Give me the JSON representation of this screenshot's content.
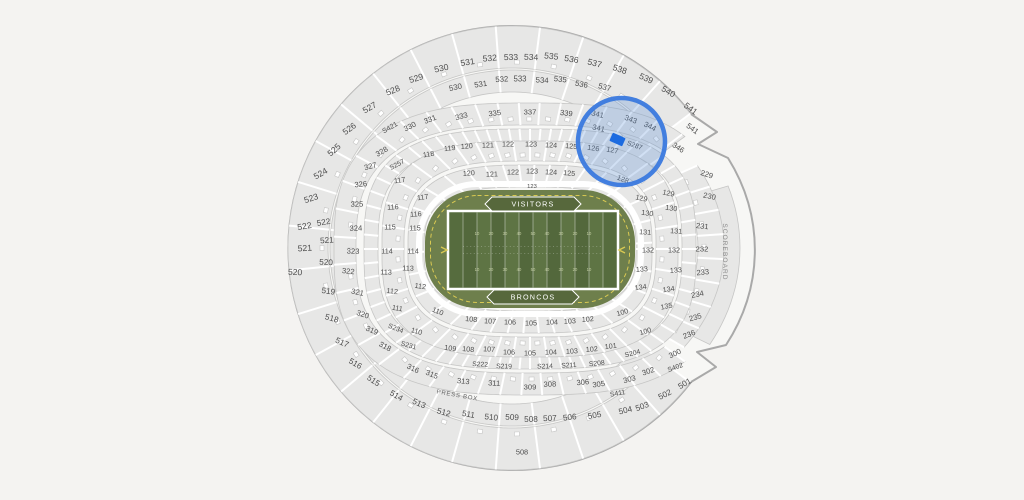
{
  "map": {
    "press_box_label": "PRESS BOX",
    "scoreboard_label": "SCOREBOARD",
    "bottom_gate_label": "508",
    "field": {
      "visitor_endzone_label": "VISITORS",
      "home_endzone_label": "BRONCOS",
      "yard_numbers": [
        "10",
        "20",
        "30",
        "40",
        "50",
        "40",
        "30",
        "20",
        "10"
      ]
    },
    "selection": {
      "highlighted_sections": [
        "341",
        "343",
        "344",
        "S287",
        "126",
        "127",
        "128"
      ],
      "highlight_stroke": "#3a79de",
      "highlight_fill": "#5b8fd6",
      "marker_color": "#1c6be0"
    },
    "colors": {
      "background": "#f4f3f1",
      "bowl_base": "#f7f7f5",
      "section_fill": "#e7e7e6",
      "section_stroke": "#c6c6c5",
      "outline": "#a9a9a9",
      "label": "#4e4e4e",
      "apron_green": "#6e7f4c",
      "stripe_dark": "#53683c",
      "stripe_light": "#5e7444",
      "endzone_green": "#566c3e",
      "banner_green": "#57683c",
      "accent_yellow": "#d9c952",
      "yard_number": "#c6d0a4",
      "scoreboard_fill": "#e9e9e8",
      "scoreboard_text": "#8a8a8a"
    },
    "label_format": [
      "text",
      "x",
      "y",
      "rotate",
      "font_size"
    ],
    "section_labels": [
      [
        "530",
        442,
        68,
        -13,
        8.6
      ],
      [
        "531",
        468,
        62,
        -9,
        8.6
      ],
      [
        "532",
        490,
        58,
        -5,
        8.6
      ],
      [
        "533",
        511,
        57,
        -1,
        8.6
      ],
      [
        "534",
        531,
        57,
        2,
        8.6
      ],
      [
        "535",
        551,
        56,
        6,
        8.6
      ],
      [
        "536",
        571,
        59,
        10,
        8.6
      ],
      [
        "537",
        594,
        63,
        14,
        8.6
      ],
      [
        "538",
        619,
        69,
        18,
        8.6
      ],
      [
        "539",
        645,
        78,
        24,
        8.6
      ],
      [
        "540",
        667,
        91,
        30,
        8.6
      ],
      [
        "541",
        689,
        108,
        36,
        8.6
      ],
      [
        "529",
        417,
        78,
        -17,
        8.6
      ],
      [
        "528",
        394,
        90,
        -23,
        8.6
      ],
      [
        "527",
        371,
        107,
        -30,
        8.6
      ],
      [
        "526",
        351,
        128,
        -36,
        8.6
      ],
      [
        "525",
        336,
        149,
        -42,
        8.6
      ],
      [
        "524",
        322,
        173,
        -30,
        8.6
      ],
      [
        "523",
        312,
        198,
        -18,
        8.6
      ],
      [
        "522",
        305,
        226,
        -10,
        8.6
      ],
      [
        "521",
        305,
        248,
        -4,
        8.6
      ],
      [
        "520",
        295,
        272,
        2,
        8.6
      ],
      [
        "522",
        324,
        222,
        -10,
        8.2
      ],
      [
        "521",
        327,
        240,
        -4,
        8.2
      ],
      [
        "520",
        326,
        262,
        2,
        8.2
      ],
      [
        "519",
        328,
        291,
        8,
        8.2
      ],
      [
        "518",
        331,
        318,
        16,
        8.2
      ],
      [
        "517",
        341,
        342,
        24,
        8.2
      ],
      [
        "516",
        354,
        363,
        30,
        8.2
      ],
      [
        "515",
        372,
        380,
        34,
        8.2
      ],
      [
        "514",
        395,
        395,
        30,
        8.2
      ],
      [
        "513",
        418,
        403,
        24,
        8.2
      ],
      [
        "512",
        443,
        412,
        16,
        8.2
      ],
      [
        "511",
        468,
        414,
        10,
        8.2
      ],
      [
        "510",
        491,
        417,
        6,
        8.2
      ],
      [
        "509",
        512,
        417,
        2,
        8.2
      ],
      [
        "508",
        531,
        419,
        0,
        8.2
      ],
      [
        "507",
        550,
        418,
        -2,
        8.2
      ],
      [
        "506",
        570,
        417,
        -6,
        8.2
      ],
      [
        "505",
        595,
        415,
        -10,
        8.2
      ],
      [
        "504",
        626,
        410,
        -14,
        8.2
      ],
      [
        "503",
        643,
        406,
        -20,
        8.2
      ],
      [
        "502",
        666,
        394,
        -26,
        8.2
      ],
      [
        "501",
        686,
        383,
        -31,
        8.2
      ],
      [
        "508",
        522,
        452,
        0,
        7.4
      ],
      [
        "530",
        456,
        87,
        -12,
        7.8
      ],
      [
        "531",
        481,
        84,
        -8,
        7.8
      ],
      [
        "532",
        502,
        79,
        -4,
        7.8
      ],
      [
        "533",
        520,
        79,
        0,
        7.8
      ],
      [
        "534",
        542,
        80,
        3,
        7.8
      ],
      [
        "535",
        560,
        79,
        7,
        7.8
      ],
      [
        "536",
        581,
        84,
        11,
        7.8
      ],
      [
        "537",
        604,
        87,
        15,
        7.8
      ],
      [
        "541",
        691,
        128,
        36,
        7.8
      ],
      [
        "331",
        431,
        119,
        -22,
        7.6
      ],
      [
        "330",
        411,
        126,
        -27,
        7.6
      ],
      [
        "S421",
        391,
        127,
        -30,
        7.0
      ],
      [
        "328",
        383,
        151,
        -30,
        7.6
      ],
      [
        "327",
        371,
        166,
        -14,
        7.6
      ],
      [
        "326",
        361,
        184,
        -6,
        7.6
      ],
      [
        "325",
        357,
        204,
        -1,
        7.6
      ],
      [
        "324",
        356,
        228,
        -2,
        7.6
      ],
      [
        "323",
        353,
        251,
        2,
        7.6
      ],
      [
        "322",
        348,
        271,
        6,
        7.6
      ],
      [
        "321",
        357,
        292,
        12,
        7.6
      ],
      [
        "320",
        362,
        314,
        18,
        7.6
      ],
      [
        "319",
        371,
        330,
        24,
        7.6
      ],
      [
        "318",
        384,
        346,
        28,
        7.6
      ],
      [
        "316",
        412,
        368,
        26,
        7.6
      ],
      [
        "315",
        431,
        374,
        22,
        7.6
      ],
      [
        "313",
        463,
        381,
        6,
        7.6
      ],
      [
        "311",
        494,
        383,
        3,
        7.6
      ],
      [
        "309",
        530,
        387,
        0,
        7.6
      ],
      [
        "308",
        550,
        384,
        -2,
        7.6
      ],
      [
        "306",
        583,
        382,
        -5,
        7.6
      ],
      [
        "305",
        599,
        384,
        -8,
        7.6
      ],
      [
        "303",
        630,
        379,
        -14,
        7.6
      ],
      [
        "302",
        649,
        371,
        -18,
        7.6
      ],
      [
        "300",
        676,
        353,
        -26,
        7.6
      ],
      [
        "333",
        462,
        116,
        -14,
        7.6
      ],
      [
        "335",
        495,
        113,
        -7,
        7.6
      ],
      [
        "337",
        530,
        112,
        0,
        7.6
      ],
      [
        "339",
        566,
        113,
        7,
        7.6
      ],
      [
        "341",
        597,
        114,
        13,
        7.6
      ],
      [
        "341",
        598,
        128,
        13,
        7.6
      ],
      [
        "343",
        630,
        119,
        20,
        7.6
      ],
      [
        "344",
        649,
        126,
        26,
        7.6
      ],
      [
        "346",
        677,
        147,
        33,
        7.6
      ],
      [
        "S257",
        398,
        164,
        -28,
        6.8
      ],
      [
        "S287",
        634,
        145,
        20,
        6.8
      ],
      [
        "S234",
        395,
        328,
        22,
        6.8
      ],
      [
        "S231",
        408,
        345,
        16,
        6.8
      ],
      [
        "S222",
        480,
        364,
        3,
        6.8
      ],
      [
        "S219",
        504,
        366,
        1,
        6.8
      ],
      [
        "S214",
        545,
        366,
        -1,
        6.8
      ],
      [
        "S211",
        569,
        365,
        -3,
        6.8
      ],
      [
        "S208",
        597,
        363,
        -6,
        6.8
      ],
      [
        "S204",
        633,
        353,
        -14,
        6.8
      ],
      [
        "S402",
        676,
        367,
        -20,
        6.8
      ],
      [
        "S411",
        618,
        393,
        -10,
        6.8
      ],
      [
        "118",
        429,
        154,
        -10,
        7.2
      ],
      [
        "119",
        450,
        148,
        -7,
        7.2
      ],
      [
        "120",
        467,
        146,
        -5,
        7.2
      ],
      [
        "121",
        488,
        145,
        -2,
        7.2
      ],
      [
        "122",
        508,
        144,
        0,
        7.2
      ],
      [
        "123",
        531,
        144,
        1,
        7.2
      ],
      [
        "124",
        551,
        145,
        3,
        7.2
      ],
      [
        "125",
        571,
        146,
        5,
        7.2
      ],
      [
        "126",
        593,
        148,
        8,
        7.2
      ],
      [
        "127",
        612,
        150,
        10,
        7.2
      ],
      [
        "128",
        622,
        179,
        22,
        7.2
      ],
      [
        "129",
        668,
        193,
        12,
        7.2
      ],
      [
        "130",
        671,
        208,
        8,
        7.2
      ],
      [
        "131",
        676,
        231,
        4,
        7.2
      ],
      [
        "132",
        674,
        250,
        0,
        7.2
      ],
      [
        "133",
        676,
        270,
        -4,
        7.2
      ],
      [
        "134",
        669,
        289,
        -8,
        7.2
      ],
      [
        "135",
        667,
        306,
        -12,
        7.2
      ],
      [
        "100",
        646,
        331,
        -16,
        7.2
      ],
      [
        "101",
        611,
        346,
        -7,
        7.2
      ],
      [
        "102",
        592,
        349,
        -5,
        7.2
      ],
      [
        "103",
        572,
        351,
        -3,
        7.2
      ],
      [
        "104",
        551,
        352,
        -1,
        7.2
      ],
      [
        "105",
        530,
        353,
        0,
        7.2
      ],
      [
        "106",
        509,
        352,
        1,
        7.2
      ],
      [
        "107",
        489,
        349,
        3,
        7.2
      ],
      [
        "108",
        468,
        349,
        5,
        7.2
      ],
      [
        "109",
        450,
        348,
        8,
        7.2
      ],
      [
        "110",
        416,
        331,
        16,
        7.2
      ],
      [
        "111",
        397,
        308,
        10,
        7.2
      ],
      [
        "112",
        392,
        291,
        6,
        7.2
      ],
      [
        "113",
        386,
        272,
        2,
        7.2
      ],
      [
        "114",
        387,
        251,
        0,
        7.2
      ],
      [
        "115",
        390,
        227,
        0,
        7.2
      ],
      [
        "116",
        393,
        207,
        -4,
        7.2
      ],
      [
        "117",
        400,
        180,
        -8,
        7.2
      ],
      [
        "120",
        469,
        173,
        -4,
        7.2
      ],
      [
        "121",
        492,
        174,
        -2,
        7.2
      ],
      [
        "122",
        513,
        172,
        0,
        7.2
      ],
      [
        "123",
        532,
        171,
        1,
        7.2
      ],
      [
        "124",
        551,
        172,
        3,
        7.2
      ],
      [
        "125",
        569,
        173,
        5,
        7.2
      ],
      [
        "123",
        532,
        186,
        0,
        5.8
      ],
      [
        "129",
        641,
        198,
        12,
        7.2
      ],
      [
        "130",
        647,
        213,
        8,
        7.2
      ],
      [
        "131",
        645,
        232,
        4,
        7.2
      ],
      [
        "132",
        648,
        250,
        0,
        7.2
      ],
      [
        "133",
        642,
        269,
        -4,
        7.2
      ],
      [
        "134",
        641,
        287,
        -8,
        7.2
      ],
      [
        "100",
        623,
        312,
        -16,
        7.2
      ],
      [
        "102",
        588,
        319,
        -5,
        7.2
      ],
      [
        "103",
        570,
        321,
        -3,
        7.2
      ],
      [
        "104",
        552,
        322,
        -1,
        7.2
      ],
      [
        "105",
        531,
        323,
        0,
        7.2
      ],
      [
        "106",
        510,
        322,
        1,
        7.2
      ],
      [
        "107",
        490,
        321,
        3,
        7.2
      ],
      [
        "108",
        471,
        319,
        5,
        7.2
      ],
      [
        "110",
        437,
        311,
        22,
        7.2
      ],
      [
        "117",
        423,
        197,
        -8,
        7.2
      ],
      [
        "116",
        416,
        214,
        -4,
        7.2
      ],
      [
        "115",
        415,
        228,
        0,
        7.2
      ],
      [
        "114",
        413,
        251,
        0,
        7.2
      ],
      [
        "113",
        408,
        268,
        2,
        7.2
      ],
      [
        "112",
        420,
        286,
        8,
        7.2
      ],
      [
        "229",
        706,
        174,
        18,
        7.6
      ],
      [
        "230",
        709,
        196,
        12,
        7.6
      ],
      [
        "231",
        702,
        226,
        6,
        7.6
      ],
      [
        "232",
        702,
        249,
        0,
        7.6
      ],
      [
        "233",
        703,
        272,
        -6,
        7.6
      ],
      [
        "234",
        698,
        294,
        -12,
        7.6
      ],
      [
        "235",
        696,
        317,
        -16,
        7.6
      ],
      [
        "236",
        690,
        334,
        -22,
        7.6
      ]
    ]
  }
}
